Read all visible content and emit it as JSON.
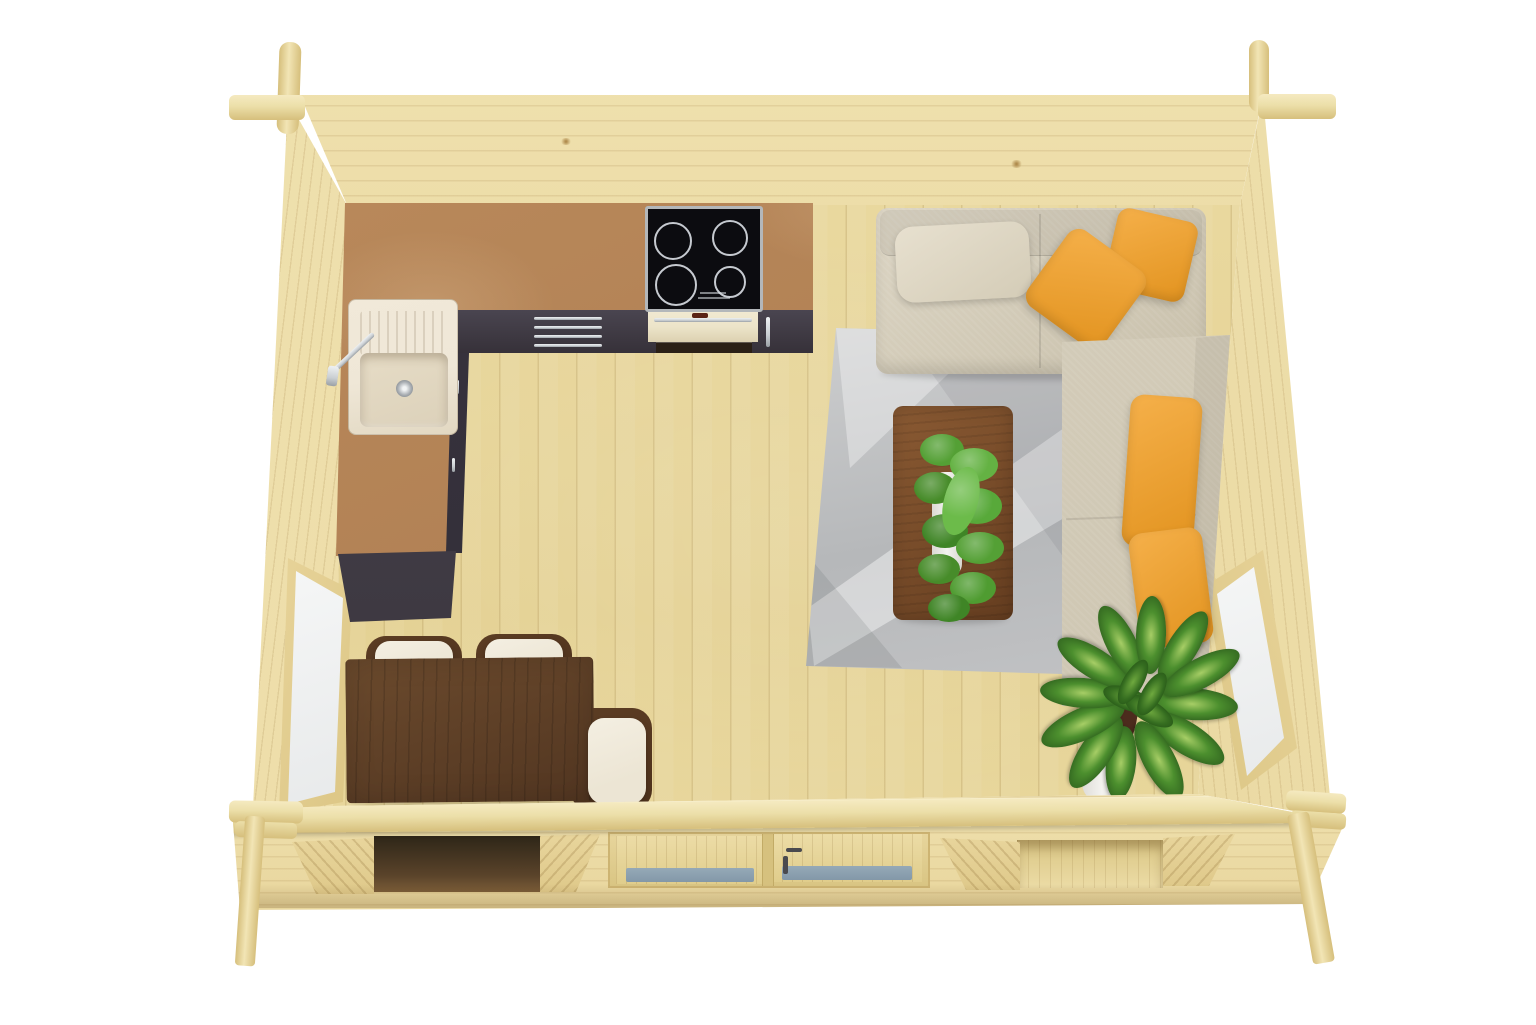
{
  "meta": {
    "title": "Log cabin interior - top-down 3D render",
    "description": "Bird's-eye 3D visualization of a single-room garden log cabin with kitchenette, corner sofa, dining set, rug and plants",
    "render_type": "3d-floorplan",
    "background": "white studio"
  },
  "palette": {
    "bg": "#ffffff",
    "wall_light": "#f0e2b0",
    "wall_mid": "#e8d59c",
    "wall_dark": "#dfc98a",
    "beam": "#ecdfa9",
    "beam_dark": "#d6bf7c",
    "floor_a": "#ecdca4",
    "floor_b": "#e4d193",
    "cork_a": "#bd8d5e",
    "cork_b": "#a5744a",
    "cab_a": "#4a4550",
    "cab_b": "#363139",
    "chrome": "#c9ced2",
    "hob_black": "#0c0c10",
    "hob_ring": "#c6cad0",
    "hob_frame": "#b3b7ba",
    "oven_cream": "#ece4c9",
    "oven_dark": "#2b2016",
    "sink_cream": "#efe7d7",
    "sink_basin": "#dcd1ba",
    "sofa_a": "#ddd6c5",
    "sofa_b": "#c8c0ab",
    "pillow_a": "#f5b04a",
    "pillow_b": "#e2931f",
    "rug_a": "#cdcecf",
    "rug_b": "#b6b8ba",
    "walnut_a": "#8a5a33",
    "walnut_b": "#663e20",
    "dining_a": "#6b4a2d",
    "dining_b": "#523621",
    "cushion": "#ece5d4",
    "chair_frame": "#4e321c",
    "leaf_a": "#4c8f2e",
    "leaf_b": "#28571a",
    "leaf_light": "#a7ce66",
    "pot_white": "#f4f3f0",
    "glass_white_a": "#f6f7f7",
    "glass_white_b": "#e7e9ea",
    "glass_blue": "#8398a8",
    "frame_wood": "#e7d399",
    "opening_dark": "#3a2a16",
    "soil": "#4c2b1d"
  },
  "scene": {
    "structure": {
      "walls": "light spruce log walls with crossed corner joints",
      "floor": "vertical pale pine planks",
      "front": "glazed double door flanked by two window openings, log ledge and corner posts"
    },
    "objects": [
      {
        "name": "kitchen-counter",
        "material": "cork-brown worktop, L-shaped",
        "location": "top-left"
      },
      {
        "name": "induction-hob",
        "burners": 4,
        "color": "black with silver frame",
        "location": "top wall"
      },
      {
        "name": "built-in-oven",
        "color": "cream front, dark glass",
        "location": "below hob"
      },
      {
        "name": "kitchen-sink",
        "color": "cream granite",
        "feature": "chrome faucet, drainboard"
      },
      {
        "name": "kitchen-cabinets",
        "color": "anthracite with chrome handles"
      },
      {
        "name": "corner-sofa",
        "color": "beige fabric",
        "pillows": "4 yellow cushions",
        "location": "top-right"
      },
      {
        "name": "area-rug",
        "color": "grey geometric triangles",
        "location": "center-right"
      },
      {
        "name": "coffee-table",
        "material": "walnut",
        "decor": "green fern in white pot"
      },
      {
        "name": "dining-table",
        "material": "dark walnut",
        "chairs": 3,
        "location": "bottom-left"
      },
      {
        "name": "potted-plant",
        "species": "dieffenbachia in white pot",
        "location": "bottom-right"
      },
      {
        "name": "window-left",
        "glazing": "single white pane"
      },
      {
        "name": "window-right",
        "glazing": "single white pane"
      },
      {
        "name": "double-door",
        "glazing": "blue-grey glass panels",
        "location": "bottom wall center"
      }
    ]
  }
}
